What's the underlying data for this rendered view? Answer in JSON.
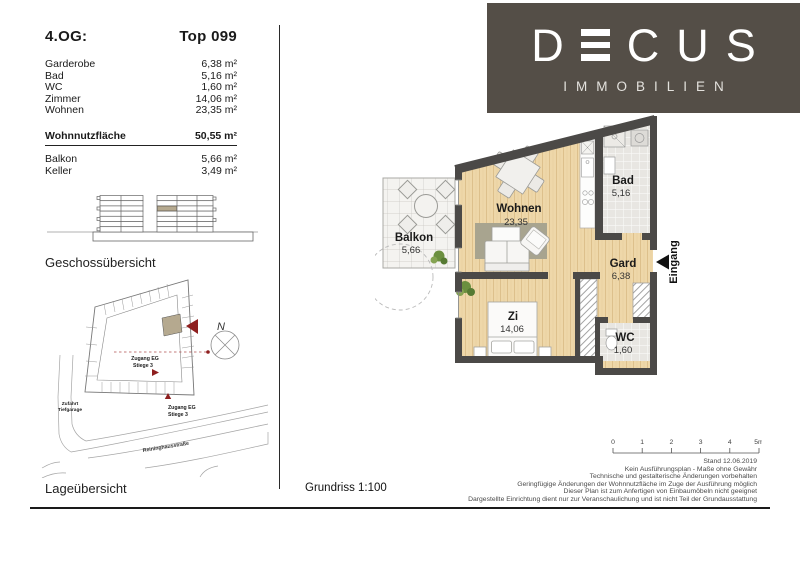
{
  "brand": {
    "pre": "D",
    "post": "C",
    "post2": "U",
    "post3": "S",
    "sub": "IMMOBILIEN",
    "bg_color": "#544e47"
  },
  "area_table": {
    "floor_label": "4.OG:",
    "unit_label": "Top 099",
    "rows": [
      {
        "label": "Garderobe",
        "value": "6,38 m²"
      },
      {
        "label": "Bad",
        "value": "5,16 m²"
      },
      {
        "label": "WC",
        "value": "1,60 m²"
      },
      {
        "label": "Zimmer",
        "value": "14,06 m²"
      },
      {
        "label": "Wohnen",
        "value": "23,35 m²"
      }
    ],
    "total_row": {
      "label": "Wohnnutzfläche",
      "value": "50,55 m²"
    },
    "extra_rows": [
      {
        "label": "Balkon",
        "value": "5,66 m²"
      },
      {
        "label": "Keller",
        "value": "3,49 m²"
      }
    ]
  },
  "floor_overview": {
    "caption": "Geschossübersicht",
    "highlight_color": "#b5a98f"
  },
  "site_overview": {
    "caption": "Lageübersicht",
    "north_label": "N",
    "access1_line1": "Zugang EG",
    "access1_line2": "Stiege 3",
    "access2_line1": "Zugang EG",
    "access2_line2": "Stiege 3",
    "garage_line1": "Zufahrt",
    "garage_line2": "Tiefgarage",
    "street_label": "Reininghausstraße",
    "accent_color": "#8e1f1f",
    "highlight_color": "#b5a98f"
  },
  "floorplan": {
    "caption": "Grundriss 1:100",
    "entrance_label": "Eingang",
    "rooms": [
      {
        "name": "Wohnen",
        "area": "23,35"
      },
      {
        "name": "Balkon",
        "area": "5,66"
      },
      {
        "name": "Bad",
        "area": "5,16"
      },
      {
        "name": "Gard",
        "area": "6,38"
      },
      {
        "name": "Zi",
        "area": "14,06"
      },
      {
        "name": "WC",
        "area": "1,60"
      }
    ],
    "wall_color": "#4b4947",
    "wood_color": "#eed7a9",
    "tile_color": "#e8e6e2"
  },
  "footer": {
    "scale_ticks": [
      "0",
      "1",
      "2",
      "3",
      "4",
      "5m"
    ],
    "disclaimer": [
      "Stand 12.06.2019",
      "Kein Ausführungsplan - Maße ohne Gewähr",
      "Technische und gestalterische Änderungen vorbehalten",
      "Geringfügige Änderungen der Wohnnutzfläche im Zuge der Ausführung möglich",
      "Dieser Plan ist zum Anfertigen von Einbaumöbeln nicht geeignet",
      "Dargestellte Einrichtung dient nur zur Veranschaulichung und ist nicht Teil der Grundausstattung"
    ]
  }
}
